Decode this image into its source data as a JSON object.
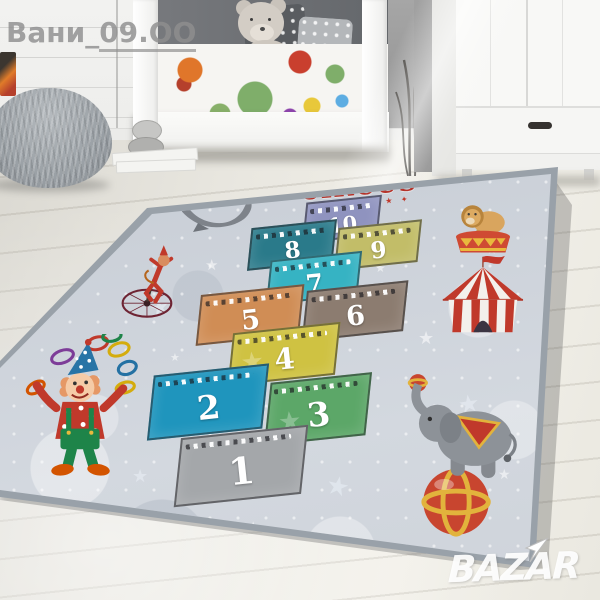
{
  "watermark": {
    "prefix": "Вани_",
    "suffix": "09.ОО"
  },
  "logo": {
    "text": "BAZAR"
  },
  "rug": {
    "title": "CIRCUS",
    "title_stars_top": "★ ★ ★ ★ ★",
    "title_stars_bottom": "✦ ★ ✦ ★ ✦ ★ ✦",
    "star_glyph": "★",
    "accent_red": "#b5332a",
    "background_color": "#cdd2da",
    "squares": [
      {
        "label": "1",
        "color": "#a4a7aa"
      },
      {
        "label": "2",
        "color": "#1f95bd"
      },
      {
        "label": "3",
        "color": "#5ca768"
      },
      {
        "label": "4",
        "color": "#cfc242"
      },
      {
        "label": "5",
        "color": "#d08d55"
      },
      {
        "label": "6",
        "color": "#8c7c70"
      },
      {
        "label": "7",
        "color": "#36b3c3"
      },
      {
        "label": "8",
        "color": "#2a7a8a"
      },
      {
        "label": "9",
        "color": "#c2bd68"
      },
      {
        "label": "10",
        "color": "#8f93bf"
      }
    ],
    "illustrations": [
      "seal-with-ball",
      "monkey-on-unicycle",
      "lion-on-podium",
      "circus-tent",
      "clown-juggling-rings",
      "elephant-on-ball"
    ]
  }
}
